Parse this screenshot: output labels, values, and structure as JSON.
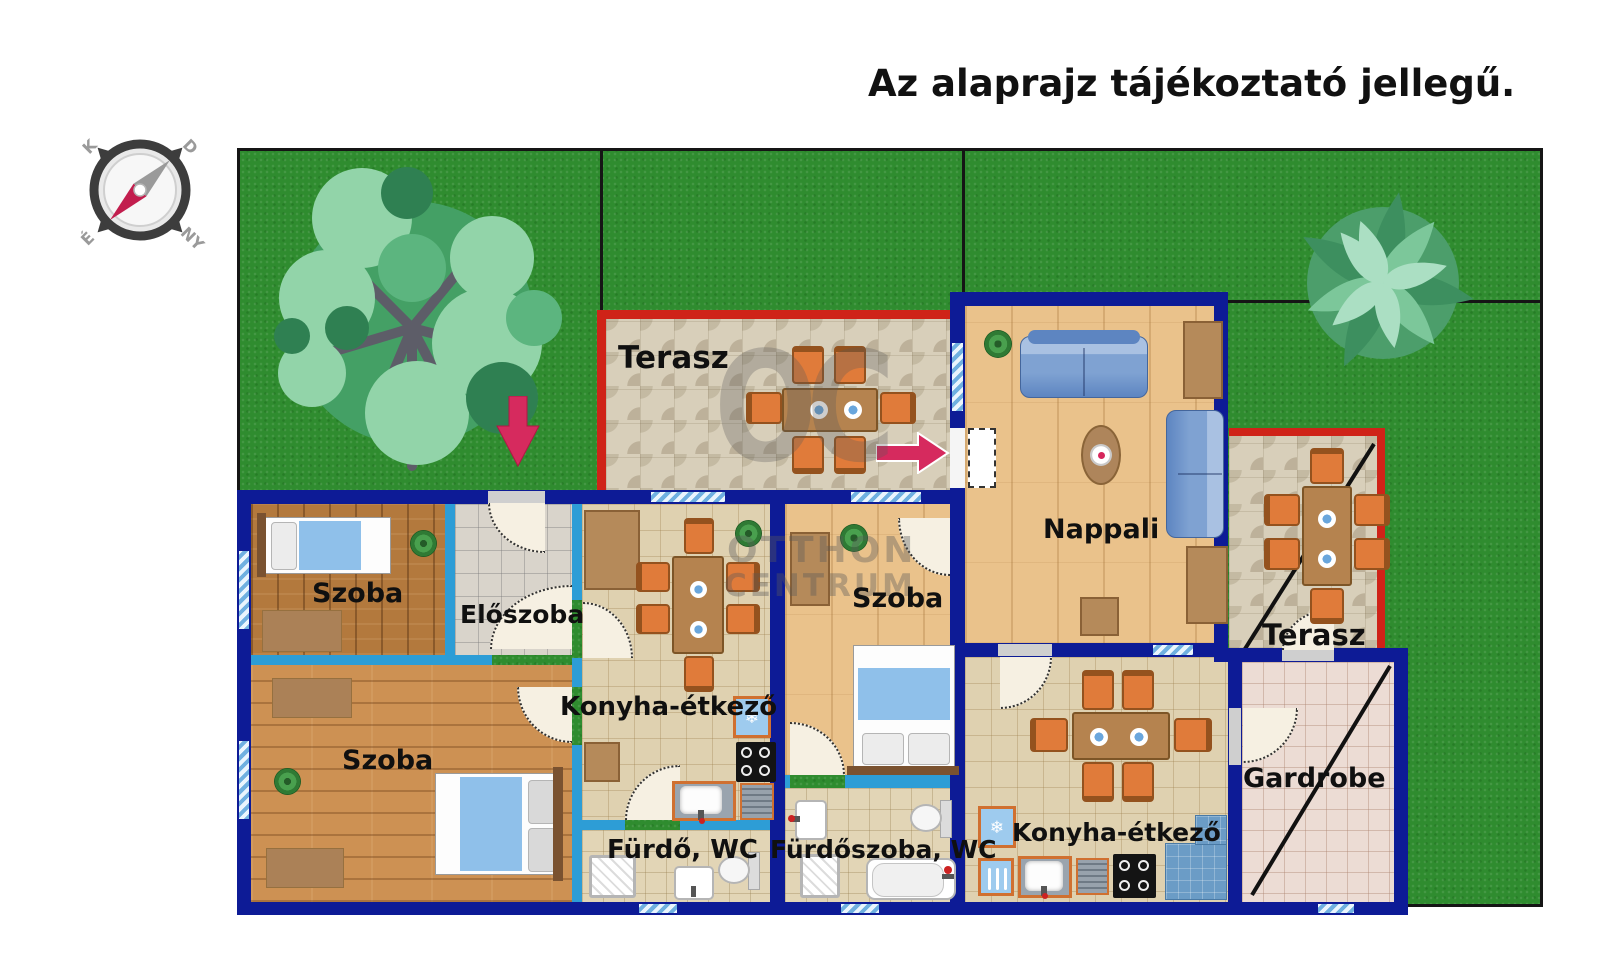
{
  "title": "Az alaprajz tájékoztató jellegű.",
  "compass": {
    "top_left": "K",
    "top_right": "D",
    "bottom_left": "É",
    "bottom_right": "NY"
  },
  "rooms": {
    "terasz_top": {
      "label": "Terasz"
    },
    "szoba_small": {
      "label": "Szoba"
    },
    "eloszoba": {
      "label": "Előszoba"
    },
    "szoba_big": {
      "label": "Szoba"
    },
    "konyha_left": {
      "label": "Konyha-étkező"
    },
    "furdo": {
      "label": "Fürdő, WC"
    },
    "szoba_mid": {
      "label": "Szoba"
    },
    "furdoszoba": {
      "label": "Fürdőszoba, WC"
    },
    "nappali": {
      "label": "Nappali"
    },
    "konyha_right": {
      "label": "Konyha-étkező"
    },
    "gardrobe": {
      "label": "Gardrobe"
    },
    "terasz_right": {
      "label": "Terasz"
    }
  },
  "watermark": {
    "monogram": "OC",
    "line1": "OTTHON",
    "line2": "CENTRUM"
  },
  "icons": {
    "snowflake": "❄"
  },
  "colors": {
    "grass": "#2f8c2f",
    "outer_wall": "#0d1b96",
    "inner_wall": "#2d9dd6",
    "terrace_border": "#cf2318",
    "accent_orange": "#e07b3a",
    "arrow": "#d62a5e"
  }
}
